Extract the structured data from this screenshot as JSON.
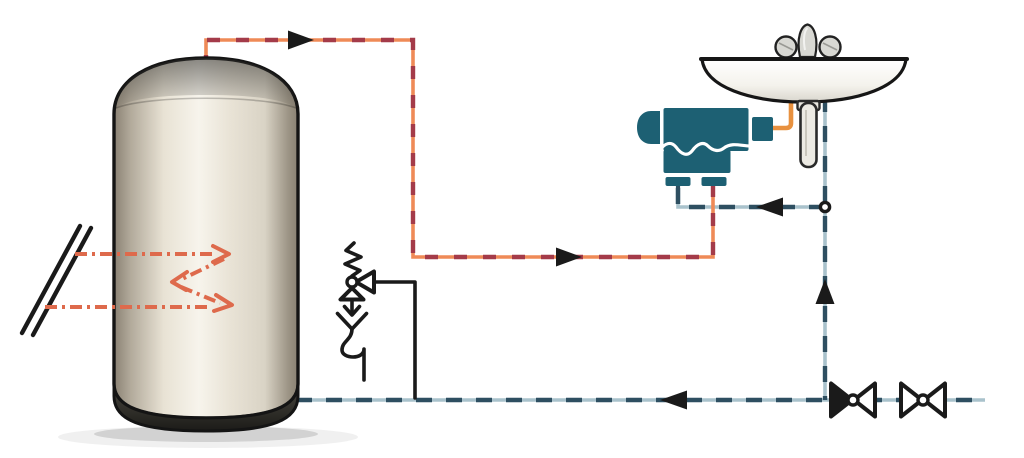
{
  "colors": {
    "background": "#ffffff",
    "hot_pipe_base": "#ef8a57",
    "hot_pipe_dash": "#a43b49",
    "cold_pipe_base": "#a9c2cc",
    "cold_pipe_dash": "#2e4f61",
    "mixed_water_pipe": "#e8913f",
    "solar_arrow": "#de6a4c",
    "mixer_teal": "#1d6073",
    "line_black": "#1a1a1a",
    "tank_edge": "#8a8173",
    "tank_mid": "#d9d3c5",
    "tank_light": "#f7f4ec",
    "tank_base": "#23221e",
    "sink_white": "#ffffff",
    "sink_shade": "#d9d6cd",
    "chrome": "#d8d8d3"
  },
  "components": {
    "solar_collector": "solar collector panel",
    "solar_heat_arrows": "solar heat transfer arrows",
    "storage_tank": "hot water storage tank",
    "safety_valve": "pressure relief safety valve with drain siphon",
    "hot_pipe": "hot water pipe from tank to mixing valve",
    "cold_pipe": "cold water supply pipe",
    "mixed_pipe": "mixed water outlet pipe",
    "mixing_valve": "thermostatic mixing valve",
    "washbasin": "washbasin with faucet",
    "faucet": "two-handle faucet",
    "drain": "basin drain tailpiece",
    "check_valve": "check valve (non-return)",
    "shutoff_valve": "shut-off valve",
    "junction": "cold water tee junction"
  }
}
